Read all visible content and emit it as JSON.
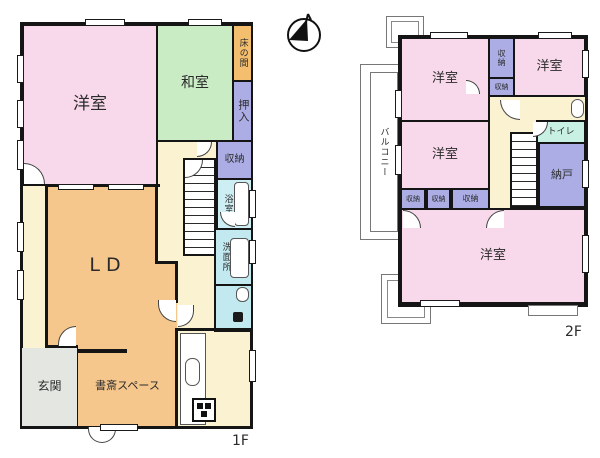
{
  "plan_title": "house-floor-plan",
  "colors": {
    "western_room": "#f8d9eb",
    "japanese_room": "#c9ecc5",
    "tokonoma": "#f3bf6f",
    "closet": "#abade4",
    "bath": "#cdeef3",
    "washroom": "#c2e9ef",
    "toilet_2f": "#c8f1e3",
    "living": "#f5c78c",
    "hall": "#fbf2d2",
    "entrance": "#e3e6e1",
    "wall": "#151515"
  },
  "floor1": {
    "floor_label": "1F",
    "rooms": {
      "youshitsu": "洋室",
      "washitsu": "和室",
      "tokonoma": "床の間",
      "oshiire": "押入",
      "shuunou": "収納",
      "yokushitsu": "浴室",
      "senmenjo": "洗面所",
      "ld": "LD",
      "genkan": "玄関",
      "shosai": "書斎スペース"
    }
  },
  "floor2": {
    "floor_label": "2F",
    "rooms": {
      "youshitsu_nw": "洋室",
      "youshitsu_ne": "洋室",
      "youshitsu_mid": "洋室",
      "youshitsu_s": "洋室",
      "shuunou_tall": "収納",
      "shuunou_small": "収納",
      "shuunou_a": "収納",
      "shuunou_b": "収納",
      "shuunou_c": "収納",
      "toire": "トイレ",
      "nando": "納戸",
      "balcony": "バルコニー"
    }
  }
}
